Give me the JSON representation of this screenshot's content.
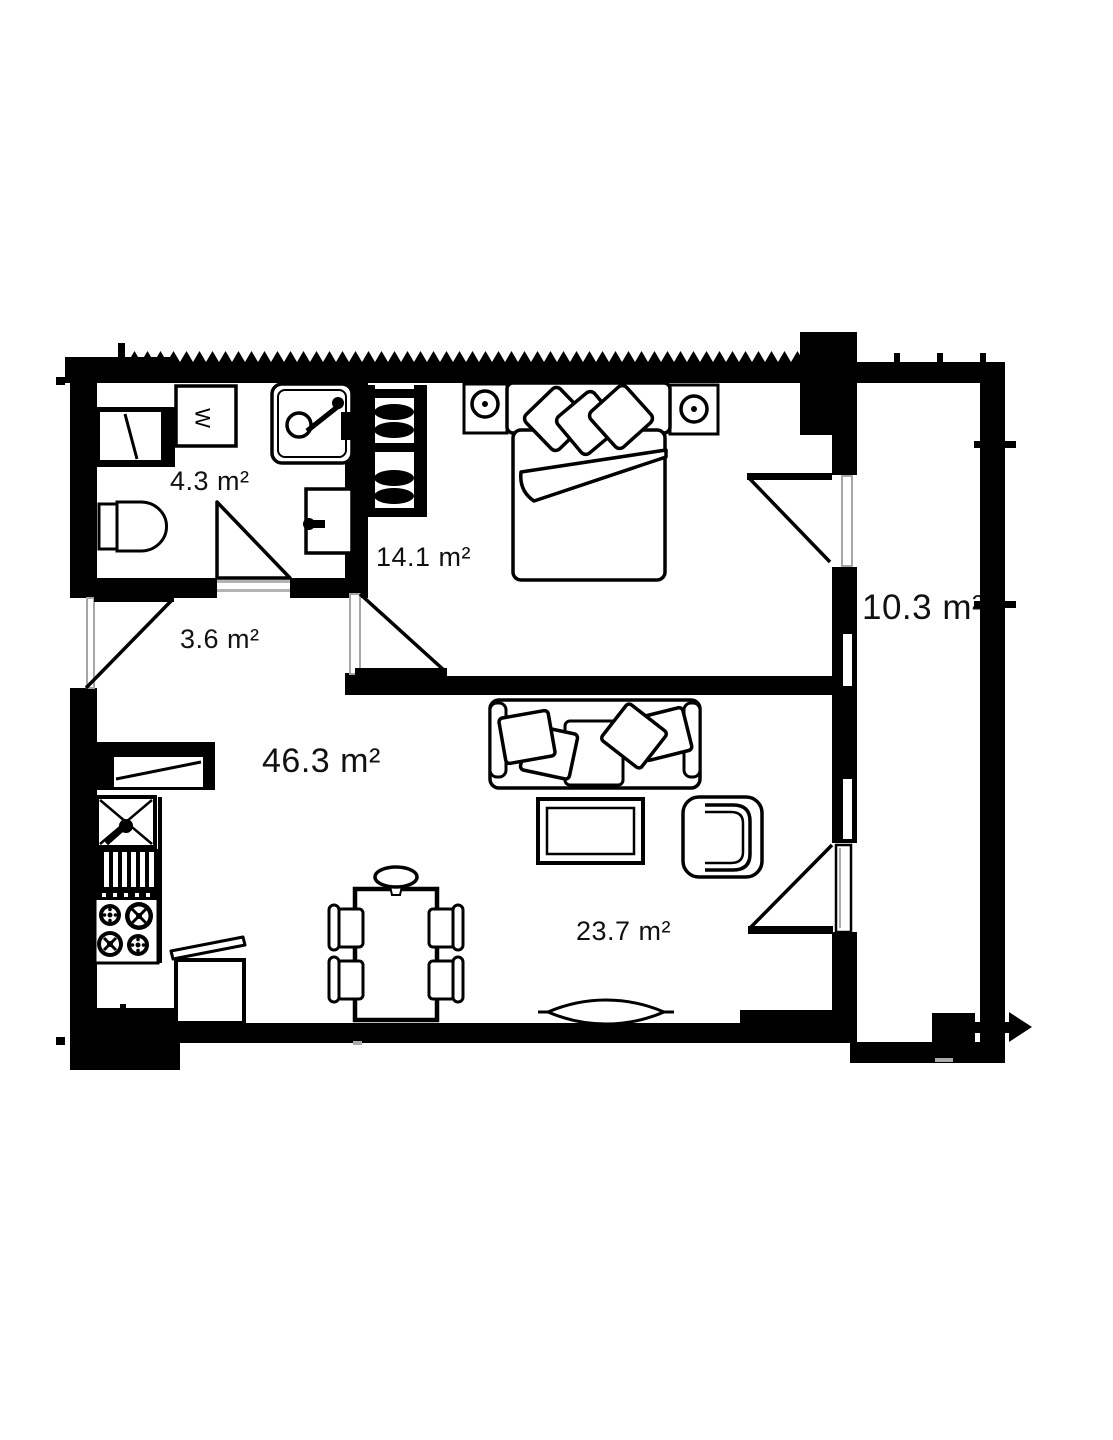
{
  "floorplan": {
    "rooms": [
      {
        "name": "bathroom",
        "area_label": "4.3 m²"
      },
      {
        "name": "hallway",
        "area_label": "3.6 m²"
      },
      {
        "name": "bedroom",
        "area_label": "14.1 m²"
      },
      {
        "name": "living-total",
        "area_label": "46.3 m²"
      },
      {
        "name": "living-zone",
        "area_label": "23.7 m²"
      },
      {
        "name": "balcony",
        "area_label": "10.3 m²"
      }
    ],
    "appliances": {
      "washer_label": "W"
    },
    "colors": {
      "wall": "#000000",
      "door_frame_gray": "#a6a6a6",
      "background": "#ffffff"
    }
  }
}
